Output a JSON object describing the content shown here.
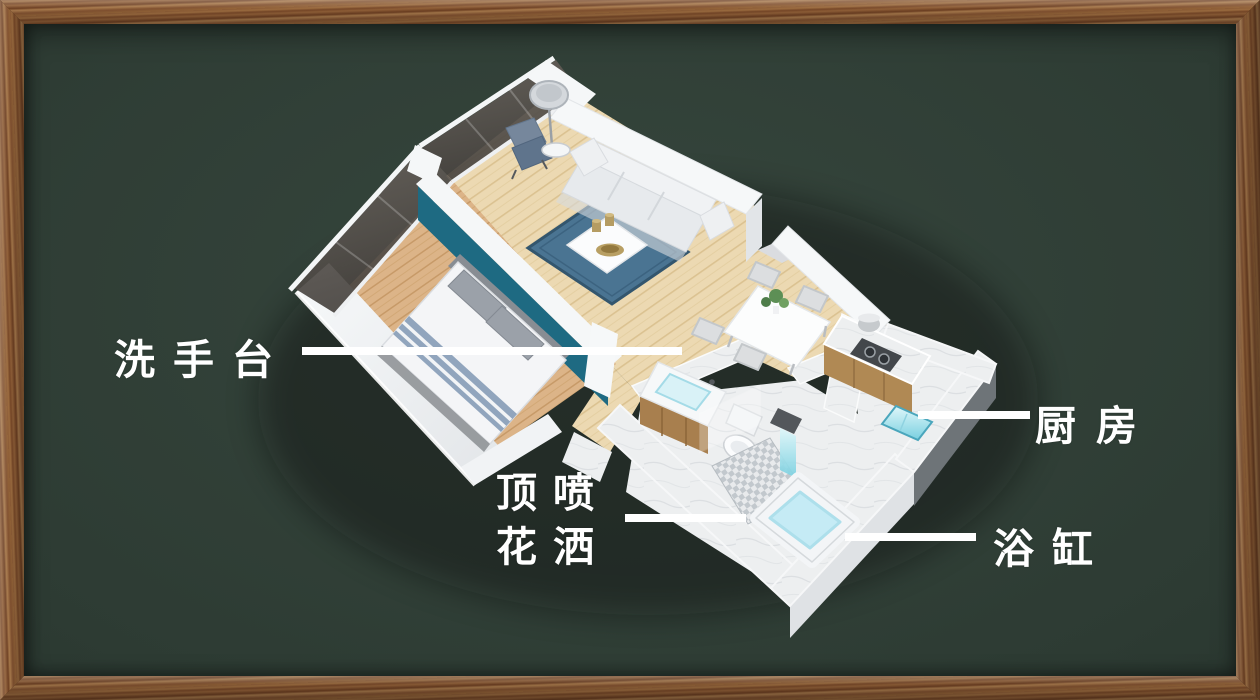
{
  "scene": {
    "type": "isometric-apartment-floorplan-infographic",
    "frame_material": "wood",
    "board_style": "chalkboard"
  },
  "colors": {
    "board_green": "#2d3b33",
    "frame_wood": "#8a5a35",
    "label_white": "#ffffff",
    "teal_accent_wall": "#1e6a82",
    "rug_blue": "#4a7492",
    "water_blue": "#c5ebf5",
    "wood_floor": "#ecd9b2",
    "bedroom_floor": "#dcb488",
    "marble": "#edeff0"
  },
  "callouts": {
    "washbasin": {
      "label": "洗手台"
    },
    "kitchen": {
      "label": "厨房"
    },
    "shower_head": {
      "label_line1": "顶喷",
      "label_line2": "花洒"
    },
    "bathtub": {
      "label": "浴缸"
    }
  }
}
